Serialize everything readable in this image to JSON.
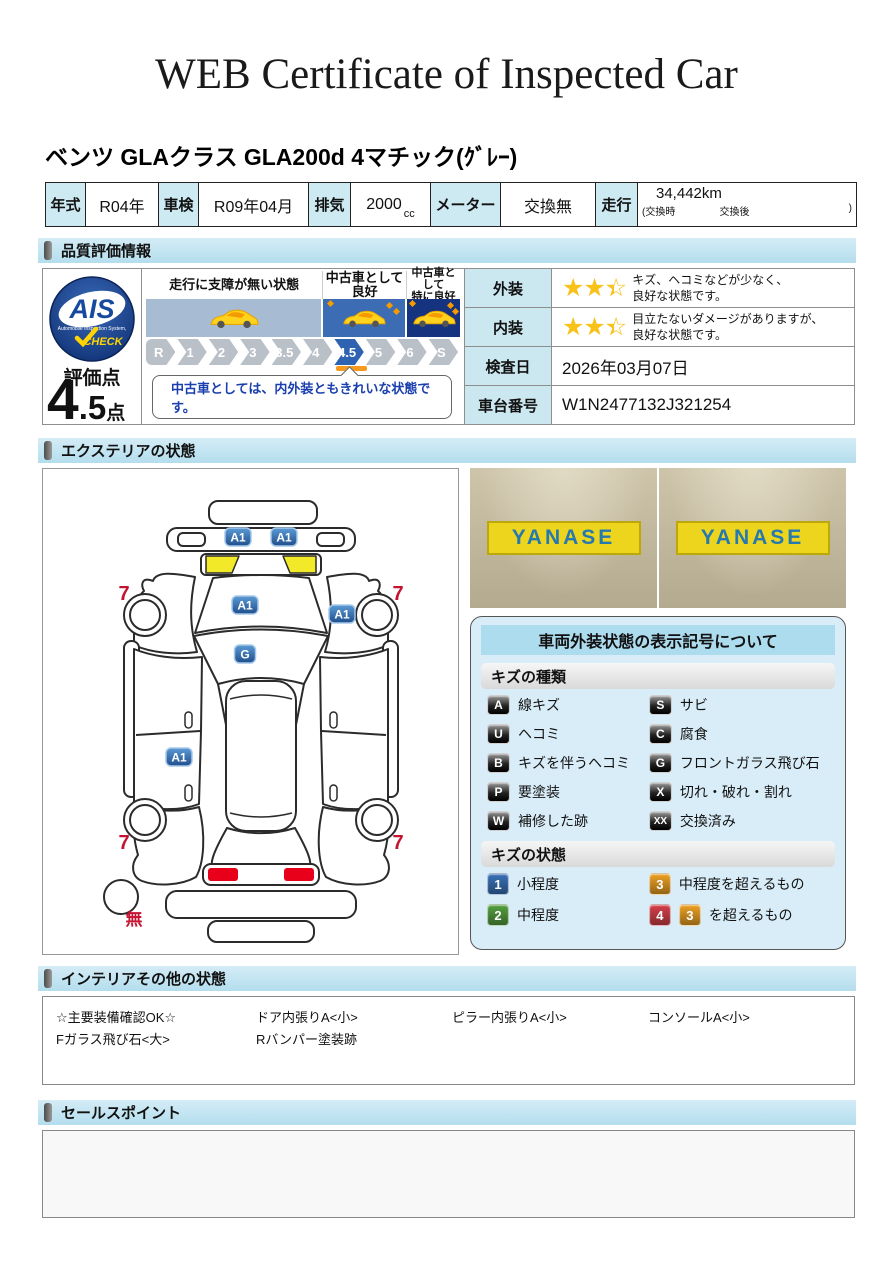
{
  "page": {
    "title": "WEB Certificate of Inspected Car"
  },
  "vehicle": {
    "name": "ベンツ GLAクラス GLA200d 4マチック(ｸﾞﾚｰ)"
  },
  "spec": {
    "items": [
      {
        "label": "年式",
        "value": "R04年"
      },
      {
        "label": "車検",
        "value": "R09年04月"
      },
      {
        "label": "排気",
        "value": "2000",
        "unit": "cc"
      },
      {
        "label": "メーター",
        "value": "交換無"
      },
      {
        "label": "走行",
        "value": "34,442km",
        "sub_left": "(交換時",
        "sub_mid": "交換後",
        "sub_close": ")"
      }
    ]
  },
  "quality": {
    "section_title": "品質評価情報",
    "ais": {
      "logo_text": "AIS",
      "logo_sub": "Automobile Inspection System,",
      "logo_check": "CHECK",
      "score_label": "評価点",
      "score": "4.5",
      "score_unit": "点"
    },
    "scale": {
      "labels": [
        "R",
        "1",
        "2",
        "3",
        "3.5",
        "4",
        "4.5",
        "5",
        "6",
        "S"
      ],
      "active": "4.5",
      "zones": [
        {
          "label": "走行に支障が無い状態"
        },
        {
          "label": "中古車として良好"
        },
        {
          "label": "中古車として\n特に良好"
        }
      ],
      "comment": "中古車としては、内外装ともきれいな状態です。"
    },
    "rows": [
      {
        "label": "外装",
        "stars": 2.5,
        "stars_max": 3,
        "lines": [
          "キズ、ヘコミなどが少なく、",
          "良好な状態です。"
        ]
      },
      {
        "label": "内装",
        "stars": 2.5,
        "stars_max": 3,
        "lines": [
          "目立たないダメージがありますが、",
          "良好な状態です。"
        ]
      },
      {
        "label": "検査日",
        "value": "2026年03月07日"
      },
      {
        "label": "車台番号",
        "value": "W1N2477132J321254"
      }
    ],
    "star_color": "#f8c219"
  },
  "exterior": {
    "section_title": "エクステリアの状態",
    "photos": [
      {
        "sign": "YANASE"
      },
      {
        "sign": "YANASE"
      }
    ],
    "marker_color": "#2e6cb8",
    "accent_red": "#c41230",
    "markers": [
      {
        "label": "A1",
        "x": 192,
        "y": 64
      },
      {
        "label": "A1",
        "x": 238,
        "y": 64
      },
      {
        "label": "A1",
        "x": 199,
        "y": 132
      },
      {
        "label": "A1",
        "x": 296,
        "y": 141
      },
      {
        "label": "G",
        "x": 199,
        "y": 181
      },
      {
        "label": "A1",
        "x": 133,
        "y": 284
      }
    ],
    "tire_labels": [
      {
        "text": "7",
        "x": 78,
        "y": 127
      },
      {
        "text": "7",
        "x": 352,
        "y": 127
      },
      {
        "text": "7",
        "x": 78,
        "y": 376
      },
      {
        "text": "7",
        "x": 352,
        "y": 376
      }
    ],
    "spare_label": {
      "text": "無",
      "x": 88,
      "y": 452
    }
  },
  "legend": {
    "title": "車両外装状態の表示記号について",
    "kind_header": "キズの種類",
    "kinds": [
      {
        "code": "A",
        "label": "線キズ"
      },
      {
        "code": "S",
        "label": "サビ"
      },
      {
        "code": "U",
        "label": "ヘコミ"
      },
      {
        "code": "C",
        "label": "腐食"
      },
      {
        "code": "B",
        "label": "キズを伴うヘコミ"
      },
      {
        "code": "G",
        "label": "フロントガラス飛び石"
      },
      {
        "code": "P",
        "label": "要塗装"
      },
      {
        "code": "X",
        "label": "切れ・破れ・割れ"
      },
      {
        "code": "W",
        "label": "補修した跡"
      },
      {
        "code": "XX",
        "label": "交換済み"
      }
    ],
    "state_header": "キズの状態",
    "states": [
      {
        "code": "1",
        "color": "#3a72b8",
        "label": "小程度"
      },
      {
        "code": "3",
        "color": "#eda124",
        "label": "中程度を超えるもの"
      },
      {
        "code": "2",
        "color": "#55a040",
        "label": "中程度"
      },
      {
        "code": "4",
        "color": "#d6404a",
        "extra_code": "3",
        "extra_color": "#eda124",
        "label": "を超えるもの"
      }
    ]
  },
  "interior": {
    "section_title": "インテリアその他の状態",
    "rows": [
      [
        "☆主要装備確認OK☆",
        "ドア内張りA<小>",
        "ピラー内張りA<小>",
        "コンソールA<小>"
      ],
      [
        "Fガラス飛び石<大>",
        "Rバンパー塗装跡",
        "",
        ""
      ]
    ]
  },
  "sales": {
    "section_title": "セールスポイント"
  }
}
